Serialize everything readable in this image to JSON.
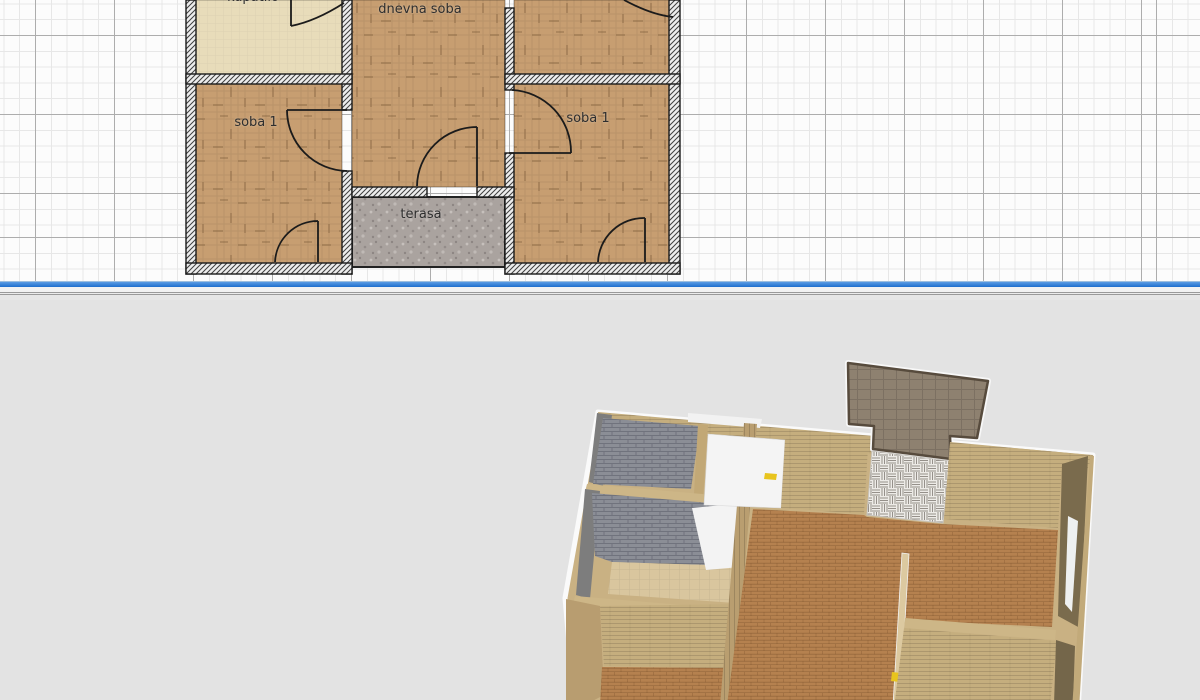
{
  "app": {
    "description": "floor plan editor with 2D plan view and 3D preview"
  },
  "plan": {
    "labels": [
      {
        "text": "kupatilo"
      },
      {
        "text": "dnevna soba"
      },
      {
        "text": "soba 1"
      },
      {
        "text": "soba 1"
      },
      {
        "text": "terasa"
      }
    ],
    "rooms": [
      {
        "name": "kupatilo",
        "floor": "cream-tile"
      },
      {
        "name": "dnevna soba",
        "floor": "parquet"
      },
      {
        "name": "soba 1 left",
        "floor": "parquet"
      },
      {
        "name": "soba 1 right",
        "floor": "parquet"
      },
      {
        "name": "top right room",
        "floor": "parquet"
      },
      {
        "name": "terasa",
        "floor": "stone"
      }
    ],
    "colors": {
      "grid_minor": "#e7e7e7",
      "grid_major": "#adadad",
      "wall_fill": "#ededed",
      "wall_hatch": "#3f3f3f",
      "parquet": "#c79e71",
      "cream": "#e8dcba",
      "stone": "#aaa39f",
      "door_stroke": "#1b1b1b"
    }
  },
  "divider": {
    "blue_line": "#2272cf",
    "splitter_groove": "#9a9a9a"
  },
  "view3d": {
    "background": "#e3e3e3",
    "colors": {
      "outline_white": "#fafafa",
      "wall_tan": "#c5ae7e",
      "wall_tan_top": "#cdb687",
      "wall_gray_face": "#7d7d7d",
      "floor_gray_brick": "#8b8e96",
      "floor_brown": "#b5814f",
      "floor_beige": "#d9c69e",
      "terrace_taupe": "#8e8170",
      "terrace_border": "#574b3d",
      "tile_white": "#edebe7",
      "door_white": "#f4f4f4",
      "handle_yellow": "#e8c41e",
      "wall_olive": "#7a6b4d"
    }
  }
}
